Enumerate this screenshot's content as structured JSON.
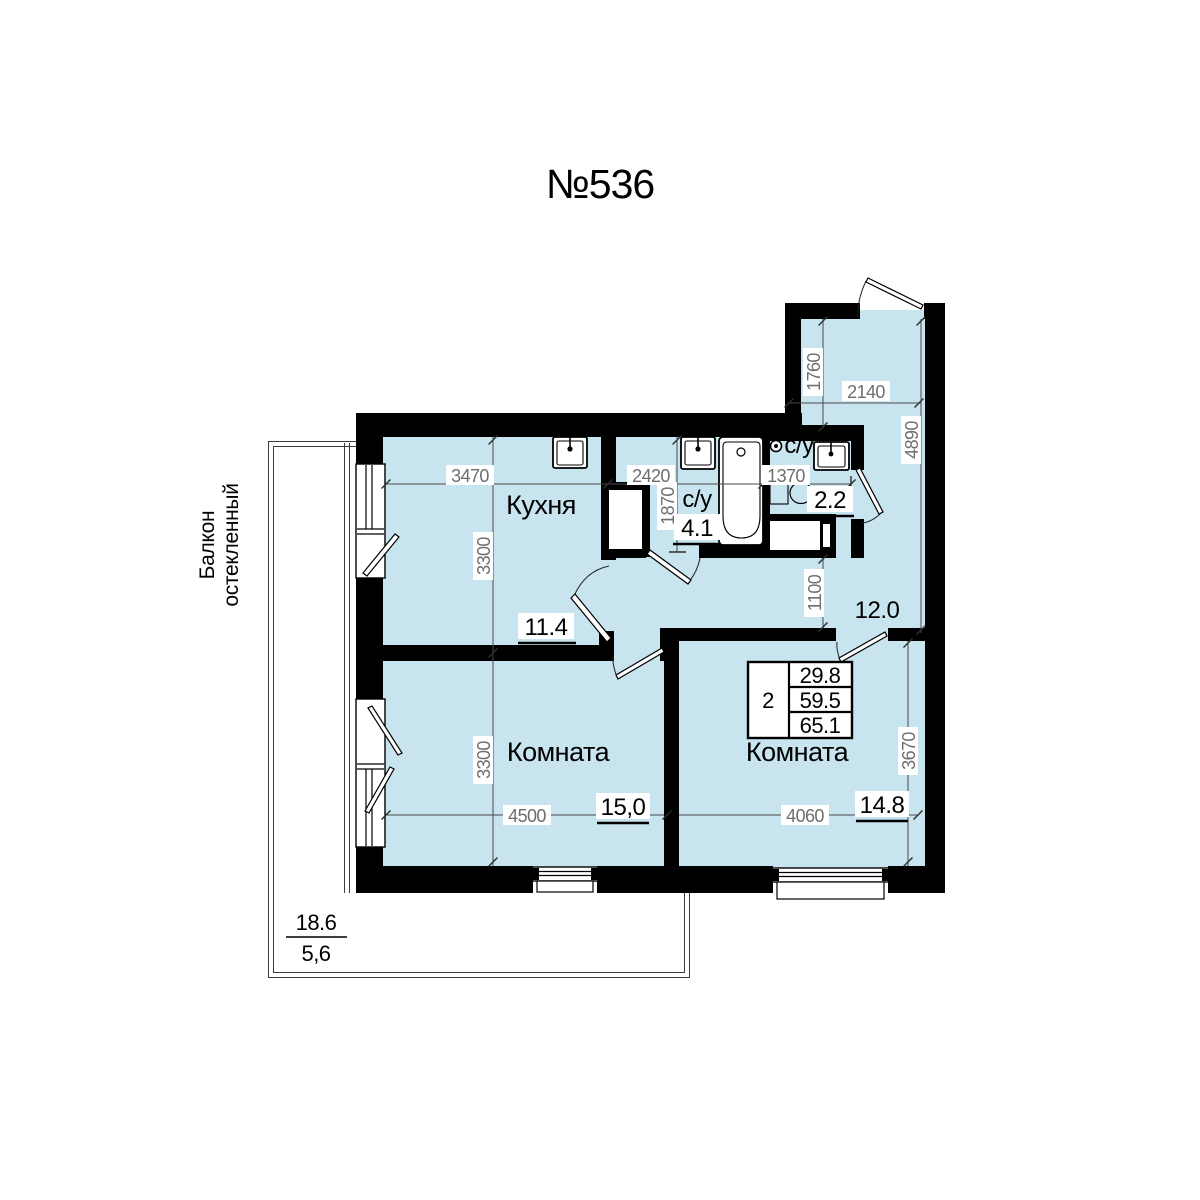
{
  "title": "№536",
  "info_box": {
    "rooms_count": "2",
    "living_area": "29.8",
    "area_without_balcony": "59.5",
    "total_area": "65.1"
  },
  "rooms": {
    "kitchen": {
      "label": "Кухня",
      "area": "11.4"
    },
    "bath1": {
      "label": "с/у",
      "area": "4.1"
    },
    "bath2": {
      "label": "с/у",
      "area": "2.2"
    },
    "hall": {
      "area": "12.0"
    },
    "room1": {
      "label": "Комната",
      "area": "15,0"
    },
    "room2": {
      "label": "Комната",
      "area": "14.8"
    }
  },
  "balcony": {
    "label_line1": "Балкон",
    "label_line2": "остекленный",
    "area_full": "18.6",
    "area_reduced": "5,6"
  },
  "dims": {
    "kitchen_w": "3470",
    "kitchen_h": "3300",
    "bath1_w": "2420",
    "bath1_h": "1870",
    "bath2_w": "1370",
    "entry_h": "1760",
    "entry_w": "2140",
    "hall_right_h": "4890",
    "hall_gap_h": "1100",
    "room1_w": "4500",
    "room1_h": "3300",
    "room2_w": "4060",
    "room2_h": "3670"
  },
  "icons": {
    "kitchen_sink": "sink-icon",
    "bath_sink": "sink-icon",
    "bathtub": "bathtub-icon",
    "toilet": "toilet-icon",
    "towel_dryer": "towel-dryer-icon",
    "washing_machine": "washing-machine-icon"
  },
  "colors": {
    "floor": "#c8e4ef",
    "wall": "#000000",
    "dim_text": "#6e6e6e"
  }
}
